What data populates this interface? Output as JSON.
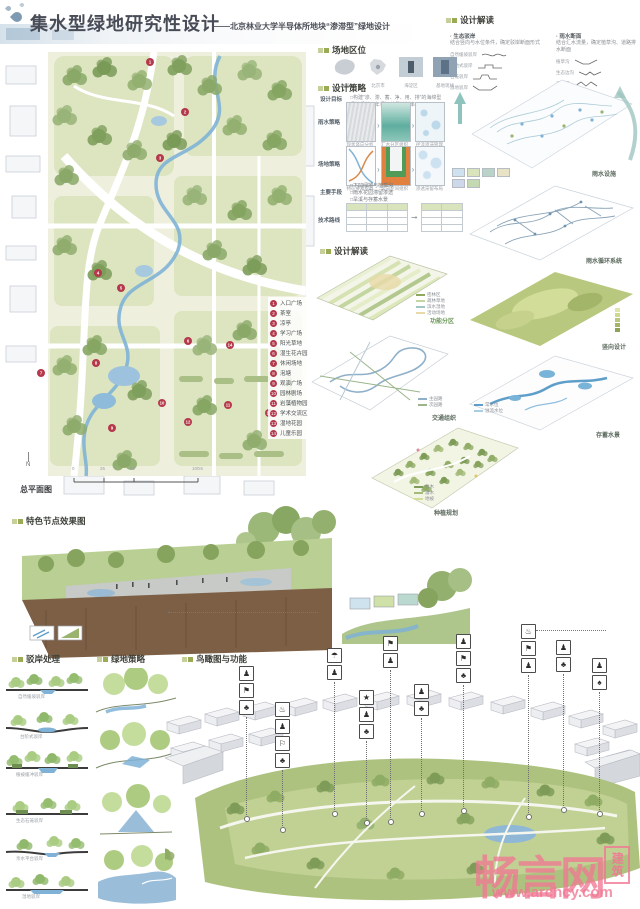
{
  "title": {
    "main": "集水型绿地研究性设计",
    "subtitle": "——北京林业大学半导体所地块“渗滞型”绿地设计"
  },
  "headers": {
    "site_location": "场地区位",
    "design_strategy": "设计策略",
    "interpret_top": "设计解读",
    "interpret_mid": "设计解读",
    "nodes": "特色节点效果图",
    "banks": "驳岸处理",
    "greens": "绿地策略",
    "birdseye": "鸟瞰图与功能"
  },
  "plan": {
    "caption": "总平面图",
    "north": "N",
    "scale_ticks": [
      "0",
      "25",
      "50",
      "100m"
    ],
    "legend": [
      {
        "n": "1",
        "label": "入口广场"
      },
      {
        "n": "2",
        "label": "茶室"
      },
      {
        "n": "3",
        "label": "凉亭"
      },
      {
        "n": "4",
        "label": "学习广场"
      },
      {
        "n": "5",
        "label": "阳光草地"
      },
      {
        "n": "6",
        "label": "湿生花卉园"
      },
      {
        "n": "7",
        "label": "休闲场地"
      },
      {
        "n": "8",
        "label": "泡塘"
      },
      {
        "n": "9",
        "label": "观演广场"
      },
      {
        "n": "10",
        "label": "园林剧场"
      },
      {
        "n": "11",
        "label": "岩藻植物园"
      },
      {
        "n": "12",
        "label": "学术交流区"
      },
      {
        "n": "13",
        "label": "湿地花园"
      },
      {
        "n": "14",
        "label": "儿童乐园"
      }
    ]
  },
  "location": {
    "captions": [
      "中国",
      "北京市",
      "海淀区",
      "基地现状"
    ]
  },
  "strategy": {
    "goal_label": "设计目标",
    "goal_text": "□构建“渗、滞、蓄、净、用、排”的海绵型绿地系统，年径流总量控制率85%",
    "rain_label": "雨水策略",
    "rain_captions": [
      "现状竖向分析",
      "汇水分区组织",
      "径流渗滞管理"
    ],
    "site_label": "场地策略",
    "site_captions": [
      "特征要素提取",
      "竖向空间组织",
      "渗透滞留布局"
    ],
    "means_label": "主要手段",
    "means_items": [
      "□下凹绿地与植草沟",
      "□雨水花园滞留渗透",
      "□旱溪与存蓄水景",
      "□溢流排放市政衔接"
    ],
    "route_label": "技术路线",
    "route_arrow": "➞"
  },
  "interpret_top": {
    "left_title": "· 生态驳岸",
    "left_desc": "结合竖向与水位条件，确定驳岸断面形式",
    "left_items": [
      "自然缓坡驳岸",
      "台地式驳岸",
      "石笼驳岸",
      "湿地驳岸"
    ],
    "right_title": "· 雨水断面",
    "right_desc": "结合汇水流量，确定植草沟、道路排水断面",
    "right_items": [
      "植草沟",
      "生态边沟",
      "渗透渠"
    ],
    "axon_caption": "雨水设施"
  },
  "axon_labels": {
    "cycle": "雨水循环系统",
    "terrain": "竖向设计",
    "water": "存蓄水景",
    "func": "功能分区",
    "traffic": "交通组织",
    "plant": "种植规划"
  },
  "mini_legends": {
    "func": [
      "密林区",
      "疏林草地",
      "滨水湿地",
      "活动场地"
    ],
    "traffic": [
      "主园路",
      "次园路"
    ],
    "plant": [
      "乔木",
      "灌木",
      "地被"
    ],
    "water": [
      "常水位",
      "溢流水位"
    ]
  },
  "banks": {
    "captions": [
      "自然缓坡驳岸",
      "台阶式驳岸",
      "植被缓冲驳岸",
      "生态石笼驳岸",
      "亲水平台驳岸",
      "湿地驳岸"
    ]
  },
  "birdseye": {
    "stacks": [
      [
        "♟",
        "⚑",
        "♣"
      ],
      [
        "♨",
        "♟",
        "⚐",
        "♣"
      ],
      [
        "☂",
        "♟"
      ],
      [
        "★",
        "♟",
        "♣"
      ],
      [
        "⚑",
        "♟"
      ],
      [
        "♟",
        "♣"
      ],
      [
        "♟",
        "⚑",
        "♣"
      ],
      [
        "♨",
        "⚑",
        "♟"
      ],
      [
        "♟",
        "♣"
      ],
      [
        "♟",
        "♠"
      ]
    ]
  },
  "watermark": {
    "brand": "畅言网",
    "seal": "建筑",
    "url": "www.archcy.com"
  }
}
